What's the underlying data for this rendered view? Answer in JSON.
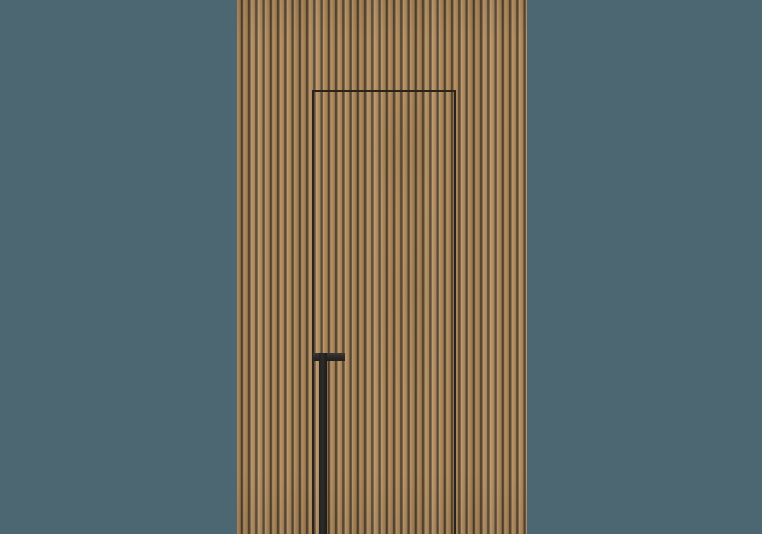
{
  "scene": {
    "type": "product-render",
    "subject": "Concealed flush door integrated into a vertical wood slat wall panel, with a long black vertical pull handle, on a plain teal studio backdrop",
    "colors": {
      "backdrop": "#4c6771",
      "wood_base": "#b08c5f",
      "wood_highlight": "#bd9a6d",
      "wood_shadow": "#a07e52",
      "groove": "#6b563f",
      "groove_deep": "#4a3a28",
      "seam": "#29231b",
      "handle": "#2d2c29",
      "handle_highlight": "#3b3a36"
    },
    "elements": {
      "backdrop_label": "teal studio backdrop",
      "panel_label": "vertical wood slat wall panel",
      "door_label": "hidden door seam outline",
      "door_grain_label": "faint wood grain on door face",
      "handle_label": "black vertical pull handle with top cap"
    }
  }
}
